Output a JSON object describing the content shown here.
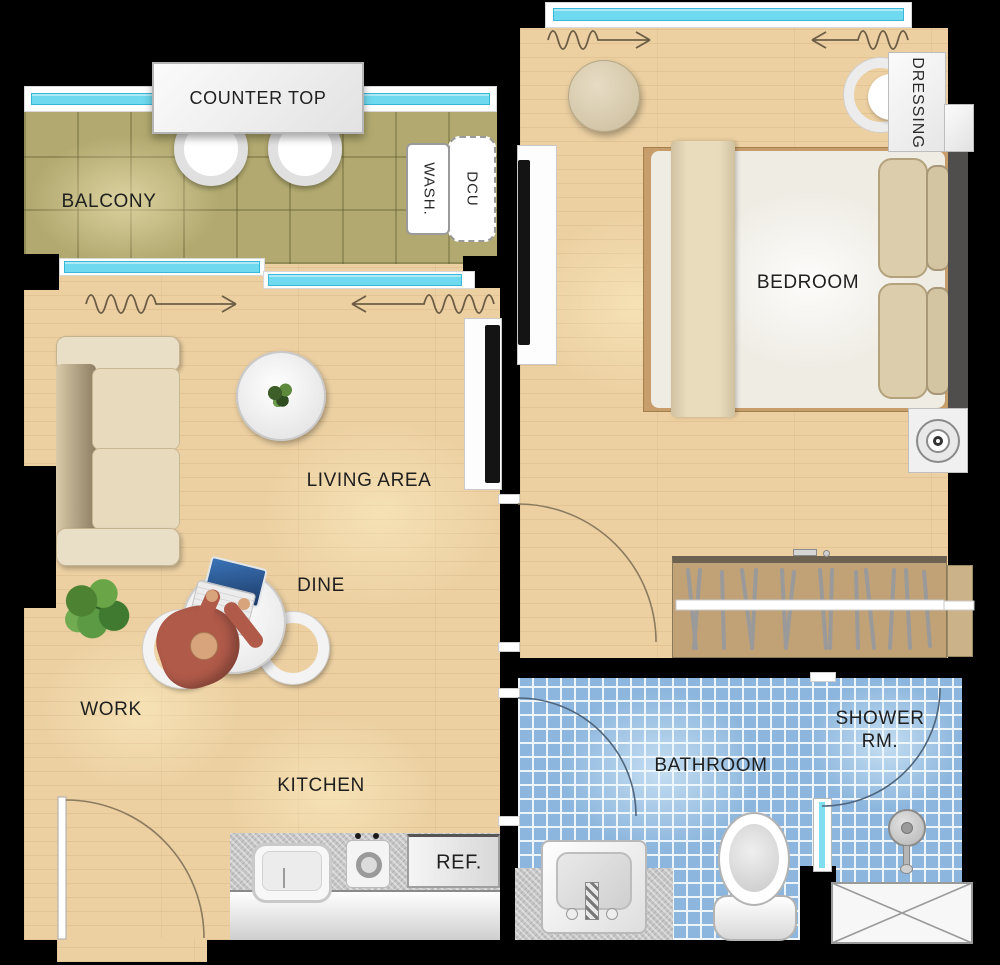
{
  "labels": {
    "balcony": "BALCONY",
    "counter_top": "COUNTER TOP",
    "washer_wash": "WASH.",
    "washer_dcu": "DCU",
    "living_area": "LIVING AREA",
    "dine": "DINE",
    "work": "WORK",
    "kitchen": "KITCHEN",
    "refrigerator": "REF.",
    "bedroom": "BEDROOM",
    "dressing": "DRESSING",
    "bathroom": "BATHROOM",
    "shower_line1": "SHOWER",
    "shower_line2": "RM."
  },
  "colors": {
    "background": "#000000",
    "wood_floor": "#ecd0a2",
    "balcony_tile": "#b1a96f",
    "bathroom_tile": "#8cb6dd",
    "window_glass": "#6fd9ef",
    "wardrobe_wood": "#c1a176",
    "sofa_beige": "#e7dabd",
    "person_shirt": "#b05a49",
    "label_text": "#1f1f1f"
  }
}
